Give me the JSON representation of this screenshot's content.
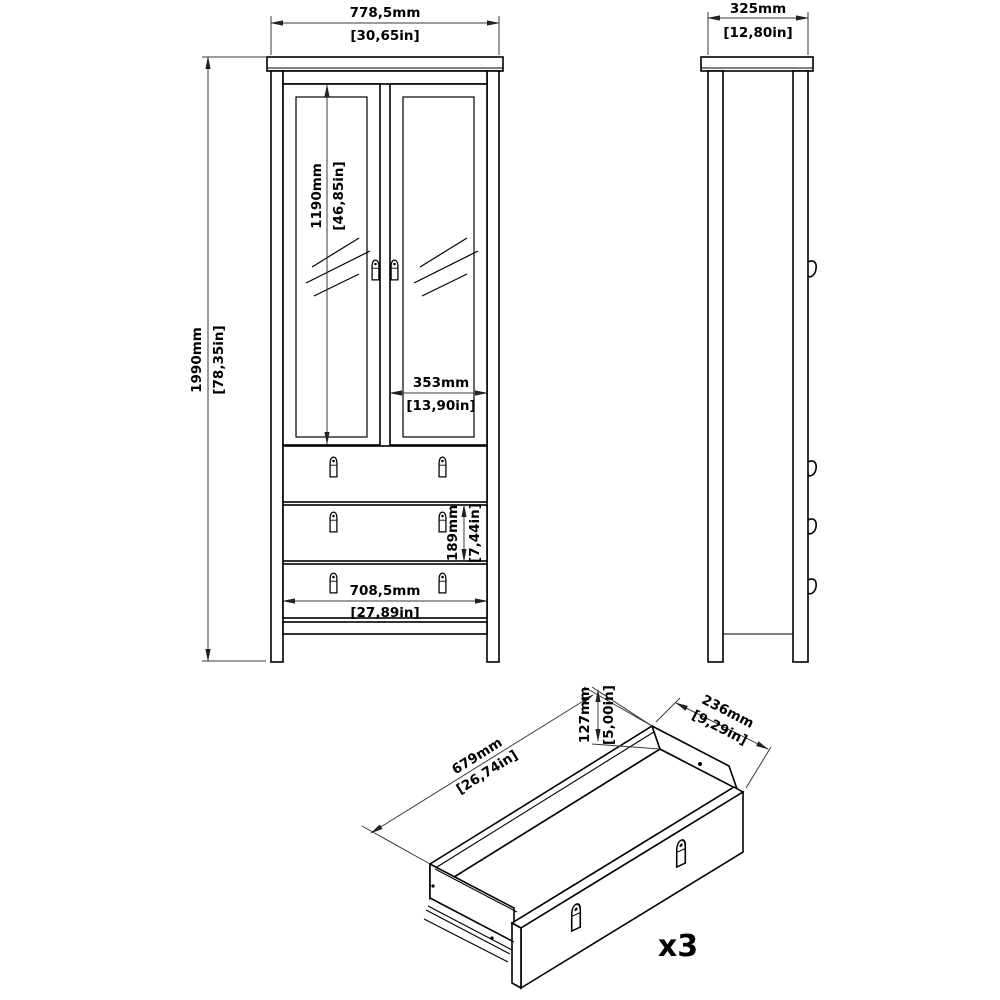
{
  "front_view": {
    "width": {
      "mm": "778,5mm",
      "inch": "[30,65in]"
    },
    "height": {
      "mm": "1990mm",
      "inch": "[78,35in]"
    },
    "door_height": {
      "mm": "1190mm",
      "inch": "[46,85in]"
    },
    "door_width": {
      "mm": "353mm",
      "inch": "[13,90in]"
    },
    "drawer_front_height": {
      "mm": "189mm",
      "inch": "[7,44in]"
    },
    "drawer_front_width": {
      "mm": "708,5mm",
      "inch": "[27,89in]"
    }
  },
  "side_view": {
    "depth": {
      "mm": "325mm",
      "inch": "[12,80in]"
    }
  },
  "drawer_detail": {
    "inner_length": {
      "mm": "679mm",
      "inch": "[26,74in]"
    },
    "inner_height": {
      "mm": "127mm",
      "inch": "[5,00in]"
    },
    "inner_depth": {
      "mm": "236mm",
      "inch": "[9,29in]"
    },
    "quantity_label": "x3"
  }
}
